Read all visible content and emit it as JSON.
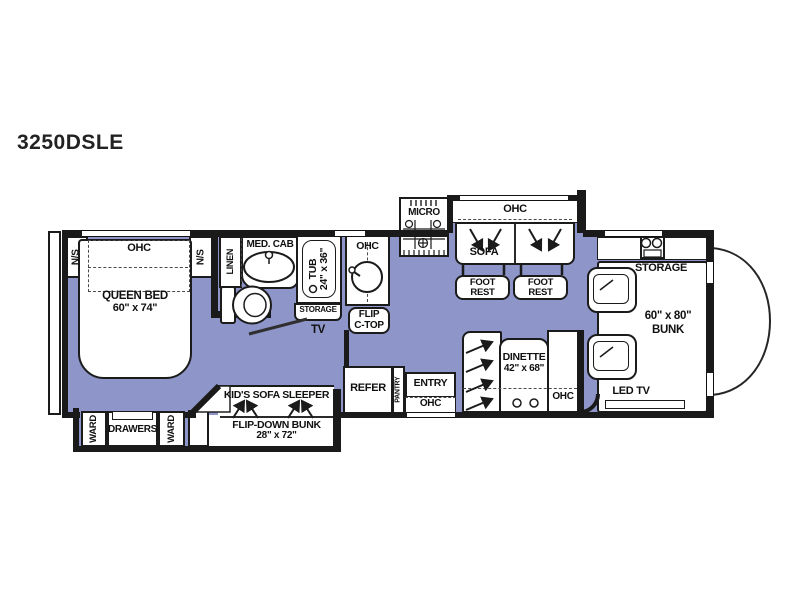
{
  "title": "3250DSLE",
  "colors": {
    "floor": "#8e95c8",
    "wall": "#1a1a1a",
    "furniture": "#ffffff"
  },
  "bedroom": {
    "ns_left": "N/S",
    "ohc": "OHC",
    "ns_right": "N/S",
    "bed1": "QUEEN BED",
    "bed2": "60\" x 74\"",
    "ward_left": "WARD",
    "drawers": "DRAWERS",
    "ward_right": "WARD"
  },
  "bath": {
    "linen": "LINEN",
    "med_cab": "MED. CAB",
    "tub1": "TUB",
    "tub2": "24\" x 36\"",
    "storage": "STORAGE",
    "tv": "TV"
  },
  "kitchen": {
    "micro": "MICRO",
    "ohc": "OHC",
    "flip1": "FLIP",
    "flip2": "C-TOP",
    "refer": "REFER",
    "pantry": "PANTRY",
    "entry": "ENTRY",
    "entry_ohc": "OHC"
  },
  "living": {
    "ohc": "OHC",
    "sofa": "SOFA",
    "foot1": "FOOT",
    "rest1": "REST",
    "foot2": "FOOT",
    "rest2": "REST"
  },
  "dinette": {
    "name": "DINETTE",
    "size": "42\" x  68\"",
    "ohc": "OHC"
  },
  "kids": {
    "sleeper": "KID'S SOFA SLEEPER",
    "bunk": "FLIP-DOWN BUNK",
    "size": "28\" x 72\""
  },
  "front": {
    "storage": "STORAGE",
    "size": "60\" x 80\"",
    "bunk": "BUNK",
    "led_tv": "LED TV"
  }
}
